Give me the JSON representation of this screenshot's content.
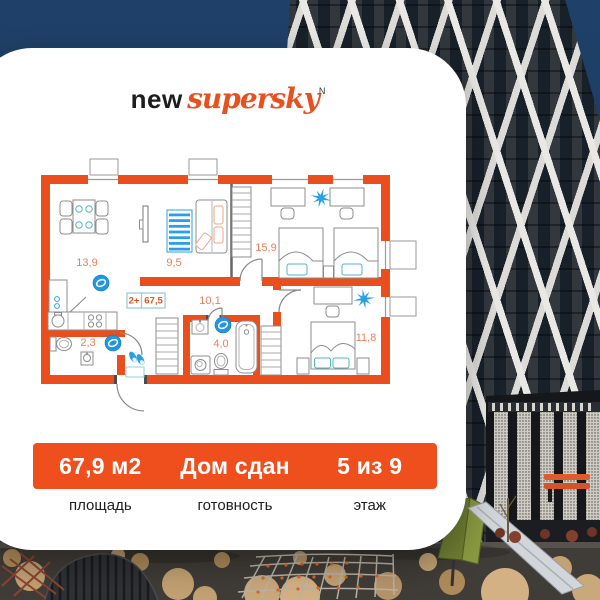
{
  "logo": {
    "word_regular": "new",
    "word_script": "supersky",
    "mark": "N"
  },
  "floor_plan": {
    "badge": {
      "rooms": "2+",
      "total_area": "67,5"
    },
    "room_labels": {
      "living": "13,9",
      "lounge": "9,5",
      "bedroom_large": "15,9",
      "hallway": "10,1",
      "bathroom": "4,0",
      "wc": "2,3",
      "bedroom_small": "11,8"
    }
  },
  "summary": {
    "items": [
      {
        "value": "67,9 м2",
        "caption": "площадь"
      },
      {
        "value": "Дом сдан",
        "caption": "готовность"
      },
      {
        "value": "5 из 9",
        "caption": "этаж"
      }
    ]
  },
  "colors": {
    "accent_orange": "#EF4E1D",
    "plan_blue": "#2B9FE4",
    "label_orange": "#E9815B",
    "sky_navy": "#1C3A5F"
  }
}
